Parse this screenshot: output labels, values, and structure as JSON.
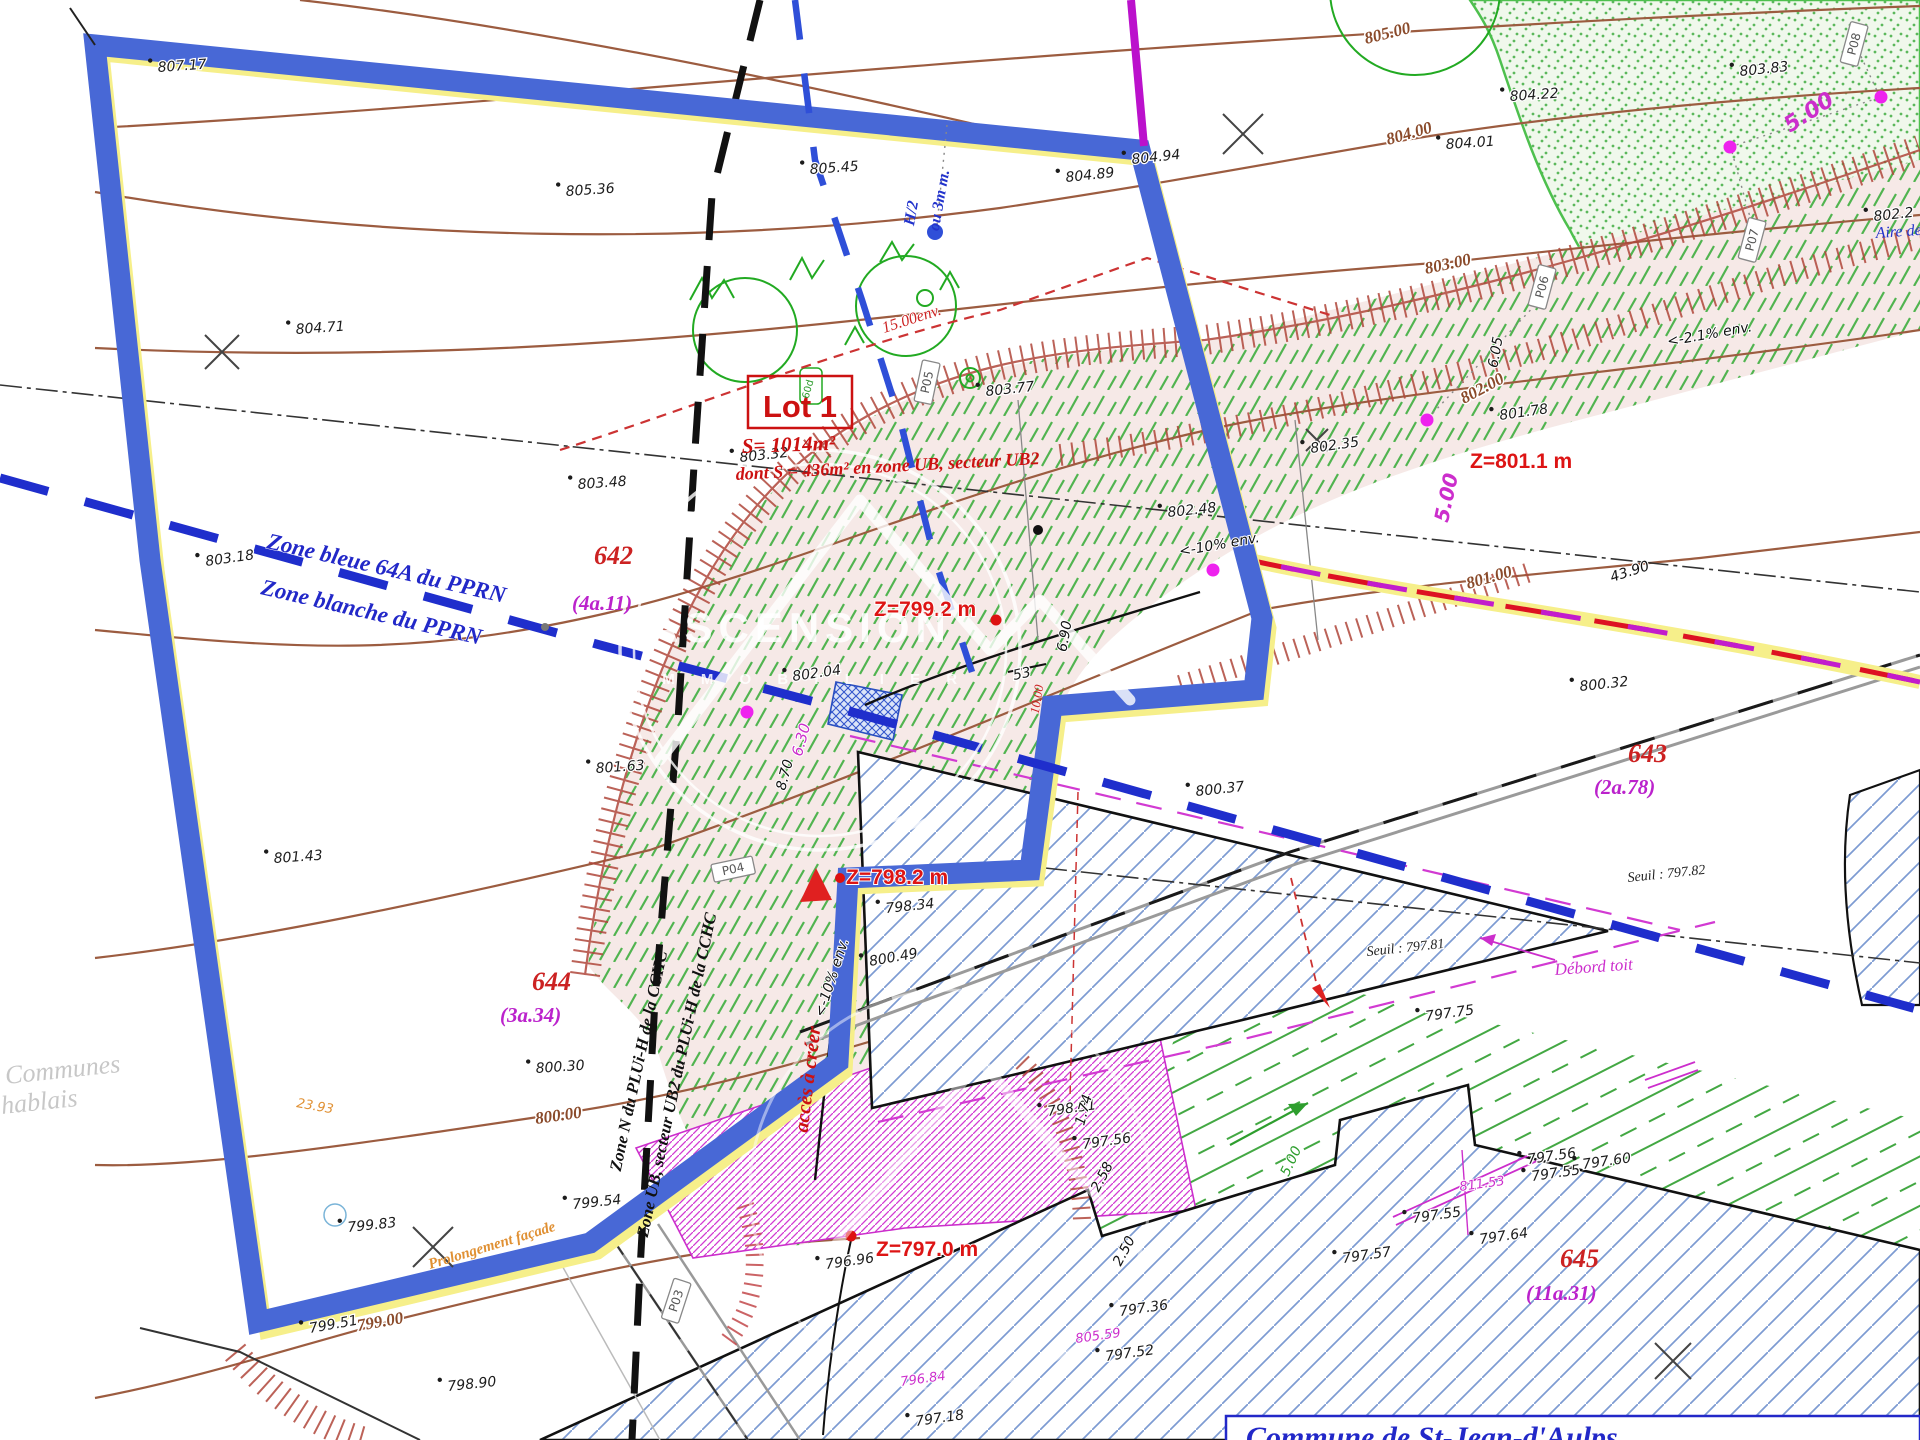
{
  "document": {
    "type": "plan de division / plan topographique",
    "commune_box": "Commune de St-Jean-d'Aulps",
    "lot": {
      "name": "Lot 1",
      "surface": "S= 1014m²",
      "surface_detail": "dont S = 436m² en zone UB, secteur UB2"
    },
    "zones": {
      "pprn_blue": "Zone bleue 64A du PPRN",
      "pprn_white": "Zone blanche du PPRN",
      "plu_n": "Zone N du PLUi-H de la CCHC",
      "plu_ub": "Zone UB, secteur UB2 du PLUi-H de la CCHC"
    },
    "parcels": [
      {
        "number": "642",
        "area": "(4a.11)"
      },
      {
        "number": "643",
        "area": "(2a.78)"
      },
      {
        "number": "644",
        "area": "(3a.34)"
      },
      {
        "number": "645",
        "area": "(11a.31)"
      }
    ],
    "platform_levels": [
      "Z=801.1 m",
      "Z=799.2 m",
      "Z=798.2 m",
      "Z=797.0 m"
    ],
    "thresholds": [
      "Seuil : 797.81",
      "Seuil : 797.82"
    ],
    "notes": [
      "accès à créer",
      "Débord toit",
      "Prolongement façade",
      "Aire de",
      "H/2",
      "ou 3m m.",
      "15.00env."
    ],
    "survey_points": [
      "P03",
      "P04",
      "P05",
      "P06",
      "P07",
      "P08"
    ],
    "watermark": {
      "logo": "ASCENSION",
      "logo_sub": "I M M O B I L I E R",
      "corner_1": "Communes",
      "corner_2": "hablais"
    },
    "colors": {
      "boundary_blue": "#4868d6",
      "boundary_yellow": "#f6ef8a",
      "pprn_blue": "#1f2ecc",
      "contour_brown": "#9c5c40",
      "green_hatch": "#3fae3f",
      "magenta": "#cc2ecc",
      "red": "#dd1414"
    }
  },
  "labels": [
    {
      "t": "807.17",
      "x": 158,
      "y": 72,
      "r": -4,
      "c": "elev"
    },
    {
      "t": "805.36",
      "x": 566,
      "y": 196,
      "r": -4,
      "c": "elev"
    },
    {
      "t": "805.45",
      "x": 810,
      "y": 174,
      "r": -4,
      "c": "elev"
    },
    {
      "t": "804.71",
      "x": 296,
      "y": 334,
      "r": -4,
      "c": "elev"
    },
    {
      "t": "804.89",
      "x": 1066,
      "y": 182,
      "r": -6,
      "c": "elev"
    },
    {
      "t": "804.94",
      "x": 1132,
      "y": 164,
      "r": -6,
      "c": "elev"
    },
    {
      "t": "804.22",
      "x": 1510,
      "y": 101,
      "r": -4,
      "c": "elev"
    },
    {
      "t": "804.01",
      "x": 1446,
      "y": 149,
      "r": -4,
      "c": "elev"
    },
    {
      "t": "803.83",
      "x": 1740,
      "y": 76,
      "r": -6,
      "c": "elev"
    },
    {
      "t": "803.77",
      "x": 986,
      "y": 396,
      "r": -6,
      "c": "elev"
    },
    {
      "t": "803.48",
      "x": 578,
      "y": 489,
      "r": -4,
      "c": "elev"
    },
    {
      "t": "803.32",
      "x": 740,
      "y": 462,
      "r": -6,
      "c": "elev"
    },
    {
      "t": "803.18",
      "x": 206,
      "y": 566,
      "r": -8,
      "c": "elev"
    },
    {
      "t": "802.2",
      "x": 1874,
      "y": 221,
      "r": -6,
      "c": "elev"
    },
    {
      "t": "802.35",
      "x": 1311,
      "y": 453,
      "r": -8,
      "c": "elev"
    },
    {
      "t": "802.48",
      "x": 1168,
      "y": 517,
      "r": -6,
      "c": "elev"
    },
    {
      "t": "802.04",
      "x": 793,
      "y": 681,
      "r": -8,
      "c": "elev"
    },
    {
      "t": "801.78",
      "x": 1500,
      "y": 420,
      "r": -8,
      "c": "elev"
    },
    {
      "t": "801.63",
      "x": 596,
      "y": 773,
      "r": -4,
      "c": "elev"
    },
    {
      "t": "801.43",
      "x": 274,
      "y": 863,
      "r": -4,
      "c": "elev"
    },
    {
      "t": "800.32",
      "x": 1580,
      "y": 691,
      "r": -6,
      "c": "elev"
    },
    {
      "t": "800.37",
      "x": 1196,
      "y": 796,
      "r": -6,
      "c": "elev"
    },
    {
      "t": "800.49",
      "x": 870,
      "y": 966,
      "r": -10,
      "c": "elev"
    },
    {
      "t": "800.30",
      "x": 536,
      "y": 1073,
      "r": -4,
      "c": "elev"
    },
    {
      "t": "799.83",
      "x": 348,
      "y": 1232,
      "r": -6,
      "c": "elev"
    },
    {
      "t": "799.54",
      "x": 573,
      "y": 1209,
      "r": -6,
      "c": "elev"
    },
    {
      "t": "799.51",
      "x": 310,
      "y": 1333,
      "r": -10,
      "c": "elev"
    },
    {
      "t": "798.90",
      "x": 448,
      "y": 1391,
      "r": -6,
      "c": "elev"
    },
    {
      "t": "798.34",
      "x": 886,
      "y": 913,
      "r": -6,
      "c": "elev"
    },
    {
      "t": "798.31",
      "x": 1048,
      "y": 1116,
      "r": -8,
      "c": "elev"
    },
    {
      "t": "796.96",
      "x": 826,
      "y": 1269,
      "r": -8,
      "c": "elev"
    },
    {
      "t": "797.56",
      "x": 1083,
      "y": 1149,
      "r": -8,
      "c": "elev"
    },
    {
      "t": "797.36",
      "x": 1120,
      "y": 1316,
      "r": -8,
      "c": "elev"
    },
    {
      "t": "797.52",
      "x": 1106,
      "y": 1361,
      "r": -8,
      "c": "elev"
    },
    {
      "t": "797.75",
      "x": 1426,
      "y": 1021,
      "r": -8,
      "c": "elev"
    },
    {
      "t": "797.57",
      "x": 1343,
      "y": 1263,
      "r": -8,
      "c": "elev"
    },
    {
      "t": "797.55",
      "x": 1413,
      "y": 1223,
      "r": -8,
      "c": "elev"
    },
    {
      "t": "797.56",
      "x": 1528,
      "y": 1164,
      "r": -8,
      "c": "elev"
    },
    {
      "t": "797.55",
      "x": 1532,
      "y": 1181,
      "r": -8,
      "c": "elev"
    },
    {
      "t": "797.60",
      "x": 1583,
      "y": 1169,
      "r": -8,
      "c": "elev"
    },
    {
      "t": "797.64",
      "x": 1480,
      "y": 1244,
      "r": -8,
      "c": "elev"
    },
    {
      "t": "797.18",
      "x": 916,
      "y": 1426,
      "r": -8,
      "c": "elev"
    },
    {
      "t": "53",
      "x": 1014,
      "y": 680,
      "r": -12,
      "c": "elev"
    },
    {
      "t": "Seuil : 797.81",
      "x": 1367,
      "y": 956,
      "r": -6,
      "c": "seuil"
    },
    {
      "t": "Seuil : 797.82",
      "x": 1628,
      "y": 882,
      "r": -6,
      "c": "seuil"
    },
    {
      "t": "805.00",
      "x": 1366,
      "y": 44,
      "r": -14,
      "c": "contour"
    },
    {
      "t": "804.00",
      "x": 1388,
      "y": 145,
      "r": -16,
      "c": "contour"
    },
    {
      "t": "803.00",
      "x": 1426,
      "y": 274,
      "r": -12,
      "c": "contour"
    },
    {
      "t": "802.00",
      "x": 1464,
      "y": 404,
      "r": -28,
      "c": "contour"
    },
    {
      "t": "801.00",
      "x": 1468,
      "y": 589,
      "r": -16,
      "c": "contour"
    },
    {
      "t": "800.00",
      "x": 536,
      "y": 1124,
      "r": -8,
      "c": "contour"
    },
    {
      "t": "799.00",
      "x": 358,
      "y": 1331,
      "r": -10,
      "c": "contour"
    },
    {
      "t": "Z=801.1 m",
      "x": 1470,
      "y": 468,
      "r": 0,
      "c": "zred"
    },
    {
      "t": "Z=799.2 m",
      "x": 874,
      "y": 616,
      "r": 0,
      "c": "zred"
    },
    {
      "t": "Z=798.2 m",
      "x": 846,
      "y": 884,
      "r": 0,
      "c": "zred"
    },
    {
      "t": "Z=797.0 m",
      "x": 876,
      "y": 1256,
      "r": 0,
      "c": "zred"
    },
    {
      "t": "Lot 1",
      "x": 800,
      "y": 417,
      "r": 0,
      "c": "lot",
      "a": "m"
    },
    {
      "t": "S= 1014m²",
      "x": 742,
      "y": 453,
      "r": -2,
      "c": "lotarea"
    },
    {
      "t": "dont S = 436m² en zone UB, secteur UB2",
      "x": 736,
      "y": 480,
      "r": -3,
      "c": "lotarea2"
    },
    {
      "t": "642",
      "x": 594,
      "y": 564,
      "r": 0,
      "c": "pnum"
    },
    {
      "t": "643",
      "x": 1628,
      "y": 762,
      "r": 0,
      "c": "pnum"
    },
    {
      "t": "644",
      "x": 532,
      "y": 990,
      "r": 0,
      "c": "pnum"
    },
    {
      "t": "645",
      "x": 1560,
      "y": 1267,
      "r": 0,
      "c": "pnum"
    },
    {
      "t": "(4a.11)",
      "x": 572,
      "y": 610,
      "r": 0,
      "c": "parea"
    },
    {
      "t": "(2a.78)",
      "x": 1594,
      "y": 794,
      "r": 0,
      "c": "parea"
    },
    {
      "t": "(3a.34)",
      "x": 500,
      "y": 1022,
      "r": 0,
      "c": "parea"
    },
    {
      "t": "(11a.31)",
      "x": 1526,
      "y": 1300,
      "r": 0,
      "c": "parea"
    },
    {
      "t": "Zone bleue 64A du PPRN",
      "x": 266,
      "y": 548,
      "r": 13,
      "c": "zoneblue"
    },
    {
      "t": "Zone blanche du PPRN",
      "x": 260,
      "y": 594,
      "r": 13,
      "c": "zoneblue"
    },
    {
      "t": "Zone N du PLUi-H de la CCHC",
      "x": 644,
      "y": 1062,
      "r": -78,
      "c": "plu",
      "a": "m"
    },
    {
      "t": "Zone UB, secteur UB2 du PLUi-H de la CCHC",
      "x": 682,
      "y": 1076,
      "r": -78,
      "c": "plu",
      "a": "m"
    },
    {
      "t": "15.00env.",
      "x": 884,
      "y": 333,
      "r": -18,
      "c": "nred"
    },
    {
      "t": "accès à créer",
      "x": 814,
      "y": 1080,
      "r": -83,
      "c": "nredbig",
      "a": "m"
    },
    {
      "t": "10.00",
      "x": 1041,
      "y": 700,
      "r": -80,
      "c": "nredsm",
      "a": "m"
    },
    {
      "t": "Débord toit",
      "x": 1555,
      "y": 975,
      "r": -4,
      "c": "nmag"
    },
    {
      "t": "811.53",
      "x": 1460,
      "y": 1191,
      "r": -8,
      "c": "nmagsm"
    },
    {
      "t": "805.59",
      "x": 1076,
      "y": 1343,
      "r": -8,
      "c": "nmagsm"
    },
    {
      "t": "796.84",
      "x": 901,
      "y": 1386,
      "r": -8,
      "c": "nmagsm"
    },
    {
      "t": "5.00",
      "x": 1453,
      "y": 499,
      "r": -78,
      "c": "dimmag",
      "a": "m"
    },
    {
      "t": "5.00",
      "x": 1790,
      "y": 133,
      "r": -33,
      "c": "dimmag2"
    },
    {
      "t": "6.30",
      "x": 806,
      "y": 741,
      "r": -75,
      "c": "dimmagsm",
      "a": "m"
    },
    {
      "t": "8.70",
      "x": 789,
      "y": 776,
      "r": -75,
      "c": "dim",
      "a": "m"
    },
    {
      "t": "6.90",
      "x": 1069,
      "y": 637,
      "r": -80,
      "c": "dim",
      "a": "m"
    },
    {
      "t": "6.05",
      "x": 1500,
      "y": 353,
      "r": -80,
      "c": "dim",
      "a": "m"
    },
    {
      "t": "43.90",
      "x": 1612,
      "y": 582,
      "r": -18,
      "c": "dim"
    },
    {
      "t": "2.58",
      "x": 1106,
      "y": 1179,
      "r": -62,
      "c": "dim",
      "a": "m"
    },
    {
      "t": "2.50",
      "x": 1128,
      "y": 1253,
      "r": -62,
      "c": "dim",
      "a": "m"
    },
    {
      "t": "1.74",
      "x": 1088,
      "y": 1111,
      "r": -75,
      "c": "dim",
      "a": "m"
    },
    {
      "t": "5.00",
      "x": 1295,
      "y": 1163,
      "r": -65,
      "c": "dimg",
      "a": "m"
    },
    {
      "t": "23.93",
      "x": 296,
      "y": 1107,
      "r": 10,
      "c": "dimor"
    },
    {
      "t": "<-10% env.",
      "x": 836,
      "y": 979,
      "r": -72,
      "c": "dim",
      "a": "m"
    },
    {
      "t": "<-10% env.",
      "x": 1180,
      "y": 556,
      "r": -10,
      "c": "dim"
    },
    {
      "t": "<-2.1% env.",
      "x": 1668,
      "y": 346,
      "r": -10,
      "c": "dim"
    },
    {
      "t": "Prolongement façade",
      "x": 430,
      "y": 1269,
      "r": -17,
      "c": "norange"
    },
    {
      "t": "Aire de",
      "x": 1876,
      "y": 238,
      "r": -4,
      "c": "nblue"
    },
    {
      "t": "H/2",
      "x": 916,
      "y": 214,
      "r": -80,
      "c": "hb",
      "a": "m"
    },
    {
      "t": "ou 3m m.",
      "x": 944,
      "y": 201,
      "r": -80,
      "c": "hb",
      "a": "m"
    },
    {
      "t": "P03",
      "x": 680,
      "y": 1302,
      "r": -72,
      "c": "pbox",
      "a": "m"
    },
    {
      "t": "P04",
      "x": 734,
      "y": 873,
      "r": -12,
      "c": "pbox",
      "a": "m"
    },
    {
      "t": "P05",
      "x": 931,
      "y": 383,
      "r": -78,
      "c": "pbox",
      "a": "m"
    },
    {
      "t": "P06",
      "x": 1546,
      "y": 288,
      "r": -75,
      "c": "pbox",
      "a": "m"
    },
    {
      "t": "P07",
      "x": 1756,
      "y": 241,
      "r": -75,
      "c": "pbox",
      "a": "m"
    },
    {
      "t": "P08",
      "x": 1858,
      "y": 45,
      "r": -75,
      "c": "pbox",
      "a": "m"
    },
    {
      "t": "60d",
      "x": 811,
      "y": 390,
      "r": -75,
      "c": "gbox",
      "a": "m"
    },
    {
      "t": "Commune de St-Jean-d'Aulps",
      "x": 1246,
      "y": 1447,
      "r": 0,
      "c": "commune"
    },
    {
      "t": "Communes",
      "x": 6,
      "y": 1084,
      "r": -6,
      "c": "gwm"
    },
    {
      "t": "hablais",
      "x": 2,
      "y": 1114,
      "r": -6,
      "c": "gwm"
    },
    {
      "t": "ASCENSION",
      "x": 800,
      "y": 642,
      "r": 0,
      "c": "wm",
      "a": "m"
    },
    {
      "t": "I M M O B I L I E R",
      "x": 800,
      "y": 684,
      "r": 0,
      "c": "wms",
      "a": "m"
    }
  ]
}
